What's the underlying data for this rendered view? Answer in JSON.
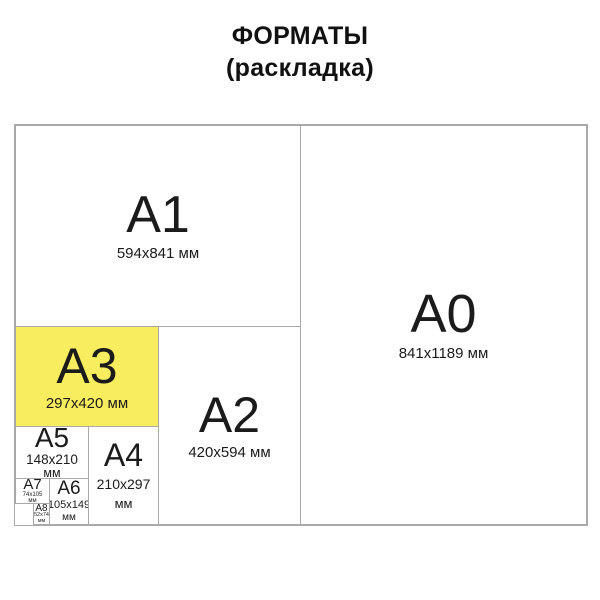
{
  "title": {
    "line1": "ФОРМАТЫ",
    "line2": "(раскладка)"
  },
  "colors": {
    "highlight_fill": "#f8ed5e",
    "line": "#a9a9a9",
    "text": "#1b1b1b"
  },
  "panels": {
    "a0": {
      "label": "A0",
      "dims": "841x1189 мм"
    },
    "a1": {
      "label": "A1",
      "dims": "594x841 мм"
    },
    "a2": {
      "label": "A2",
      "dims": "420x594 мм"
    },
    "a3": {
      "label": "A3",
      "dims": "297x420 мм",
      "highlighted": true
    },
    "a4": {
      "label": "A4",
      "dims": "210x297",
      "unit": "мм"
    },
    "a5": {
      "label": "A5",
      "dims": "148x210",
      "unit": "мм"
    },
    "a6": {
      "label": "A6",
      "dims": "105x149",
      "unit": "мм"
    },
    "a7": {
      "label": "A7",
      "dims": "74x105",
      "unit": "мм"
    },
    "a8": {
      "label": "A8",
      "dims": "52x74",
      "unit": "мм"
    }
  }
}
